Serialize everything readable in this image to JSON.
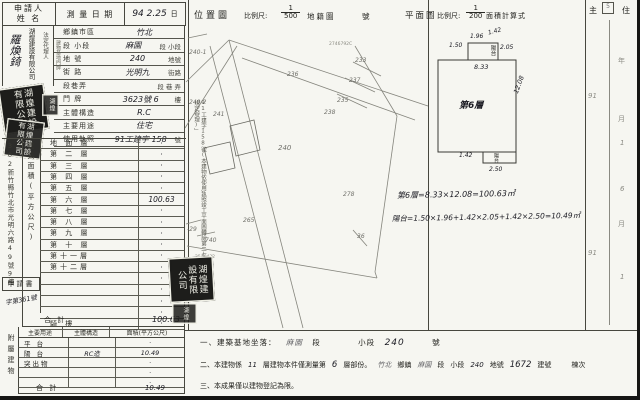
{
  "applicant": {
    "label_line1": "申請人",
    "label_line2": "姓 名",
    "name": "羅煥錡",
    "company": "湖煌建設有限公司",
    "agent_label": "法定代理人"
  },
  "survey": {
    "label": "測 量 日 期",
    "value": "94 2.25",
    "day": "日"
  },
  "location_rows": [
    {
      "label": "鄉鎮市區",
      "value": "竹北",
      "suffix": ""
    },
    {
      "label": "段 小段",
      "value": "麻園",
      "suffix": "段  小段"
    },
    {
      "label": "地  號",
      "value": "240",
      "suffix": "地號"
    },
    {
      "label": "街  路",
      "value": "光明九",
      "suffix": "街路"
    },
    {
      "label": "段巷弄",
      "value": "",
      "suffix": "段 巷 弄"
    },
    {
      "label": "門  牌",
      "value": "3623號 6",
      "suffix": "樓"
    },
    {
      "label": "主體構造",
      "value": "R.C",
      "suffix": ""
    },
    {
      "label": "主要用途",
      "value": "住宅",
      "suffix": ""
    },
    {
      "label": "使用執照",
      "value": "91工建字 158",
      "suffix": "號"
    }
  ],
  "mini_col_label": "建物基地門牌",
  "floors": {
    "side_label": "建築面積(平方公尺)",
    "address": "302新竹縣竹北市光明六路49號9樓",
    "application": {
      "label": "申請書",
      "number": "字第361號"
    },
    "rows": [
      {
        "label": "地 面 層",
        "value": "·"
      },
      {
        "label": "第 二 層",
        "value": "·"
      },
      {
        "label": "第 三 層",
        "value": "·"
      },
      {
        "label": "第 四 層",
        "value": "·"
      },
      {
        "label": "第 五 層",
        "value": "·"
      },
      {
        "label": "第 六 層",
        "value": "100.63"
      },
      {
        "label": "第 七 層",
        "value": "·"
      },
      {
        "label": "第 八 層",
        "value": "·"
      },
      {
        "label": "第 九 層",
        "value": "·"
      },
      {
        "label": "第 十 層",
        "value": "·"
      },
      {
        "label": "第十一層",
        "value": "·"
      },
      {
        "label": "第十二層",
        "value": "·"
      },
      {
        "label": "",
        "value": "·"
      },
      {
        "label": "",
        "value": "·"
      },
      {
        "label": "",
        "value": "·"
      },
      {
        "label": "",
        "value": "·"
      },
      {
        "label": "騎  樓",
        "value": "·"
      }
    ],
    "total_label": "合    計",
    "total": "100.63"
  },
  "attached": {
    "side_label": "附屬建物",
    "headers": [
      "主要用途",
      "主體構造",
      "面積(平方公尺)"
    ],
    "rows": [
      {
        "use": "平 台",
        "structure": "",
        "area": "·"
      },
      {
        "use": "陽 台",
        "structure": "RC造",
        "area": "10.49"
      },
      {
        "use": "突出物",
        "structure": "",
        "area": "·"
      },
      {
        "use": "",
        "structure": "",
        "area": "·"
      },
      {
        "use": "",
        "structure": "",
        "area": "·"
      }
    ],
    "total_label": "合  計",
    "total": "10.49"
  },
  "margin_note": "91工建字158號(本建物依使用執照竣工平面圖轉繪第二七三條規定辦理)」",
  "seal": {
    "company": "湖煌建設有限公司",
    "small": "湖煌"
  },
  "maps": {
    "location": {
      "title": "位置圖",
      "scale_label": "比例尺:",
      "num": "1",
      "den": "500",
      "type_label": "地籍圖",
      "no_label": "號",
      "parcels": [
        "236",
        "241",
        "240",
        "233",
        "237",
        "235",
        "238",
        "278",
        "265",
        "740",
        "-29",
        "36",
        "240-1",
        "240-2"
      ],
      "tiny": [
        "2746792C",
        "2546432"
      ]
    },
    "plan": {
      "title": "平面圖",
      "scale_label": "比例尺:",
      "num": "1",
      "den": "200",
      "calc_label": "面積計算式",
      "room": "第6層",
      "balcony": "陽台",
      "dims": {
        "left": "1.50",
        "top": "1.96",
        "top_right": "1.42",
        "notch_right": "2.05",
        "width": "8.33",
        "height": "12.08",
        "bottom_left": "1.42",
        "bottom_width": "2.50"
      }
    }
  },
  "formulas": {
    "f1": "第6層=8.33×12.08=100.63㎡",
    "f2": "陽台=1.50×1.96+1.42×2.05+1.42×2.50=10.49㎡"
  },
  "notes": {
    "n1_label": "一、建築基地坐落：",
    "n1_v1": "麻園",
    "n1_s1": "段",
    "n1_s2": "小段",
    "n1_v2": "240",
    "n1_s3": "號",
    "n2_a": "二、本建物係",
    "n2_v1": "11",
    "n2_b": "層建物本件僅測量第",
    "n2_v2": "6",
    "n2_c": "層部份。",
    "n2_v3": "竹北",
    "n2_d": "鄉鎮",
    "n2_v4": "麻園",
    "n2_e": "段",
    "n2_f": "小段",
    "n2_v5": "240",
    "n2_g": "地號",
    "n2_v6": "1672",
    "n2_h": "建號",
    "n2_i": "棟次",
    "n3": "三、本成果僅以建物登記為限。"
  },
  "right_strip": {
    "h1": "主",
    "box": "5",
    "h2": "住",
    "marks": [
      "91",
      "年",
      "月",
      "1",
      "6",
      "月",
      "91",
      "1"
    ]
  }
}
